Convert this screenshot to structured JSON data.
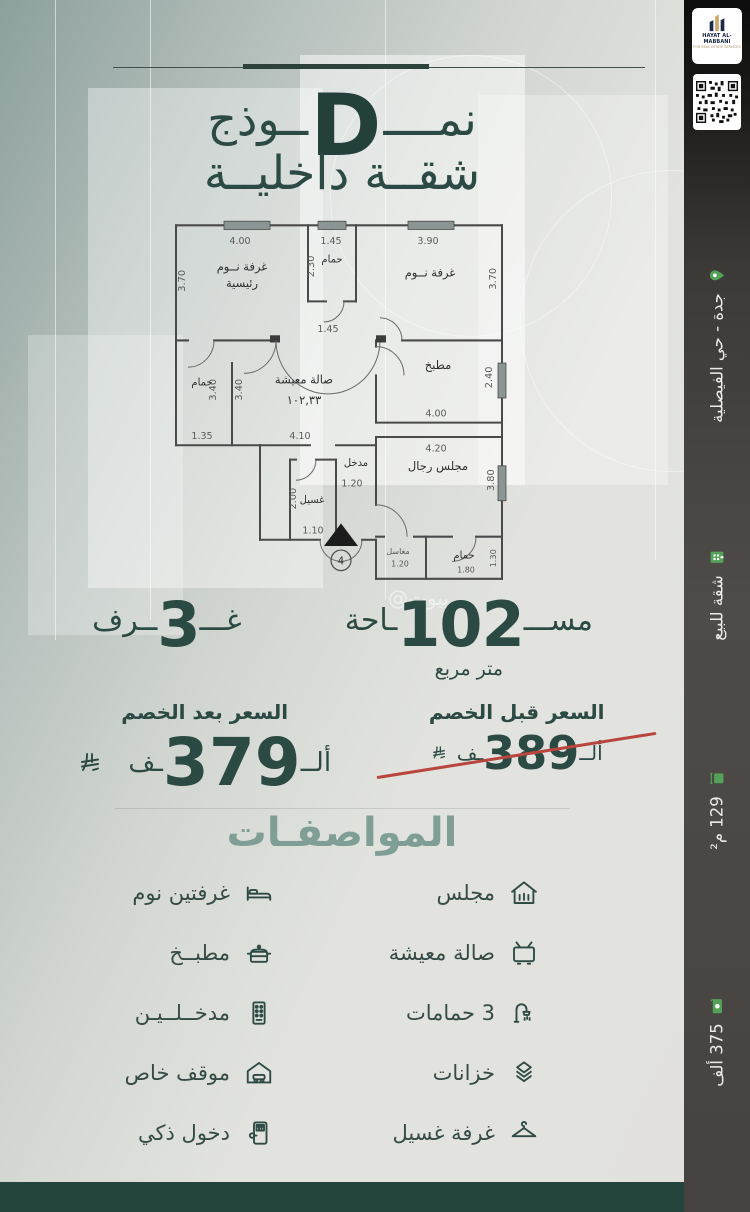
{
  "brand": {
    "logo_title": "HAYAT AL-MABBANI",
    "logo_subtitle": "FOR REAL ESTATE SERVICES"
  },
  "sidebar": {
    "items": [
      {
        "icon": "location-pin-icon",
        "label": "جدة - حي الفيصلية"
      },
      {
        "icon": "building-icon",
        "label": "شقة للبيع"
      },
      {
        "icon": "area-icon",
        "label": "129 م²"
      },
      {
        "icon": "price-tag-icon",
        "label": "375 ألف"
      }
    ]
  },
  "header": {
    "model_prefix": "نمــــ",
    "model_letter": "D",
    "model_suffix": "ــوذج",
    "subtitle": "شقــة داخليــة"
  },
  "floorplan": {
    "rooms": {
      "master_line1": "غرفة نــوم",
      "master_line2": "رئيسية",
      "bedroom": "غرفة نــوم",
      "bathroom": "حمام",
      "living": "صالة معيشة",
      "living_area": "١٠٢,٣٣",
      "kitchen": "مطبخ",
      "entrance": "مدخل",
      "laundry": "غسيل",
      "majlis": "مجلس رجال",
      "sinks": "مغاسل",
      "door_marker": "4"
    },
    "dims": {
      "d400": "4.00",
      "d145": "1.45",
      "d390": "3.90",
      "d370": "3.70",
      "d230": "2.30",
      "d340": "3.40",
      "d135": "1.35",
      "d410": "4.10",
      "d240": "2.40",
      "d420": "4.20",
      "d380": "3.80",
      "d120": "1.20",
      "d200": "2.00",
      "d110": "1.10",
      "d180": "1.80",
      "d130": "1.30"
    }
  },
  "stats": {
    "area_prefix": "مســـ",
    "area_value": "102",
    "area_suffix": "ـاحة",
    "area_unit": "متر مربع",
    "rooms_prefix": "غـــ",
    "rooms_value": "3",
    "rooms_suffix": "ــرف"
  },
  "pricing": {
    "before_label": "السعر قبل الخصم",
    "before_prefix": "ألــ",
    "before_value": "389",
    "before_suffix": "ـف",
    "after_label": "السعر بعد الخصم",
    "after_prefix": "ألــ",
    "after_value": "379",
    "after_suffix": "ـف",
    "strike_color": "#b8453e"
  },
  "specs": {
    "title": "المواصفـات",
    "items": [
      {
        "icon": "majlis-house-icon",
        "label": "مجلس"
      },
      {
        "icon": "bed-icon",
        "label": "غرفتين نوم"
      },
      {
        "icon": "tv-icon",
        "label": "صالة معيشة"
      },
      {
        "icon": "kitchen-pot-icon",
        "label": "مطبــخ"
      },
      {
        "icon": "shower-icon",
        "label": "3 حمامات"
      },
      {
        "icon": "entrance-keypad-icon",
        "label": "مدخــلــيـن"
      },
      {
        "icon": "storage-boxes-icon",
        "label": "خزانات"
      },
      {
        "icon": "garage-car-icon",
        "label": "موقف خاص"
      },
      {
        "icon": "hanger-icon",
        "label": "غرفة غسيل"
      },
      {
        "icon": "smart-lock-icon",
        "label": "دخول ذكي"
      }
    ]
  },
  "watermark": "@بيوت",
  "colors": {
    "accent_dark_green": "#2b4a43",
    "accent_sage": "#7f9e95",
    "sidebar_green_icon": "#54a257",
    "bottom_bar": "#24443e"
  }
}
